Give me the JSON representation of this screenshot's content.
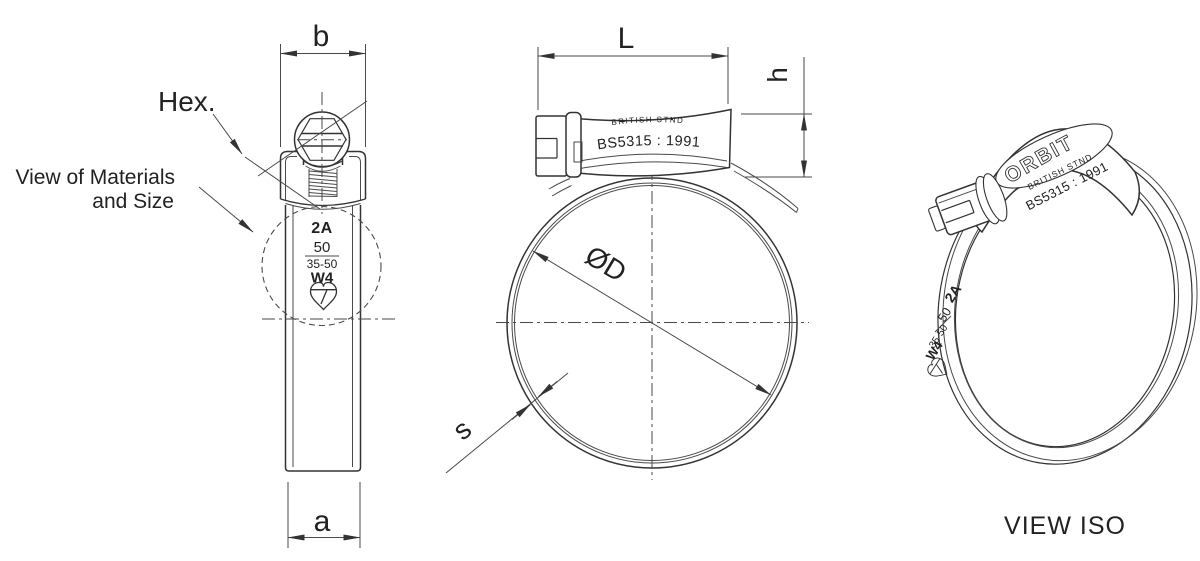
{
  "colors": {
    "background": "#ffffff",
    "line": "#333333",
    "text": "#222222"
  },
  "side_view": {
    "dim_width_housing": "b",
    "dim_width_band": "a",
    "hex_label": "Hex.",
    "note_line1": "View of Materials",
    "note_line2": "and Size",
    "markings": {
      "type_code": "2A",
      "size": "50",
      "clamp_range": "35-50",
      "material_code": "W4",
      "logo_icon": "heart-logo"
    }
  },
  "front_view": {
    "dim_length": "L",
    "dim_height": "h",
    "dim_diameter": "ØD",
    "dim_thickness": "s",
    "housing": {
      "brand": "ORBIT",
      "standard": "BRITISH STND",
      "spec": "BS5315 : 1991"
    }
  },
  "iso_view": {
    "caption": "VIEW ISO",
    "housing": {
      "brand": "ORBIT",
      "standard": "BRITISH STND",
      "spec": "BS5315 : 1991"
    },
    "markings": {
      "type_code": "2A",
      "size": "50",
      "clamp_range": "35-50",
      "material_code": "W4",
      "logo_icon": "heart-logo"
    }
  }
}
